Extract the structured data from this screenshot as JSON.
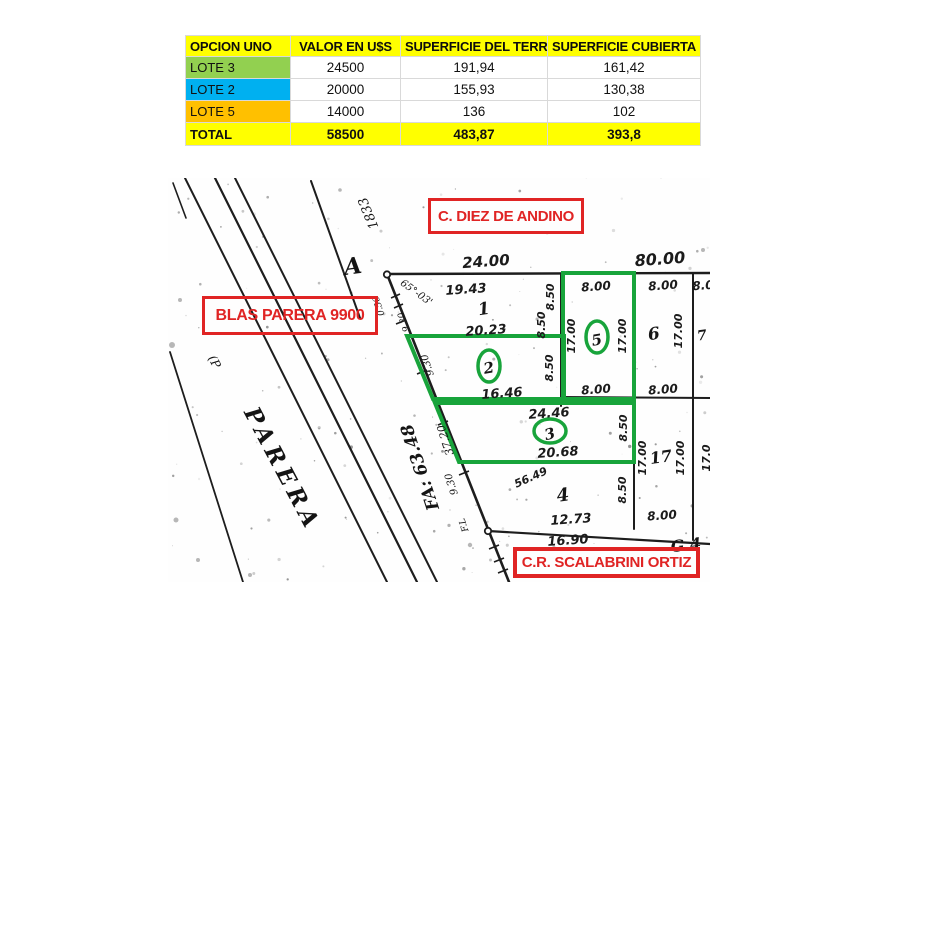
{
  "table": {
    "headers": [
      "OPCION UNO",
      "VALOR EN U$S",
      "SUPERFICIE DEL TERR.",
      "SUPERFICIE CUBIERTA"
    ],
    "header_bg": "#ffff00",
    "rows": [
      {
        "label": "LOTE 3",
        "color": "#92d050",
        "valor": "24500",
        "terreno": "191,94",
        "cubierta": "161,42"
      },
      {
        "label": "LOTE 2",
        "color": "#00b0f0",
        "valor": "20000",
        "terreno": "155,93",
        "cubierta": "130,38"
      },
      {
        "label": "LOTE 5",
        "color": "#ffc000",
        "valor": "14000",
        "terreno": "136",
        "cubierta": "102"
      }
    ],
    "total": {
      "label": "TOTAL",
      "valor": "58500",
      "terreno": "483,87",
      "cubierta": "393,8",
      "bg": "#ffff00"
    }
  },
  "map": {
    "labels": {
      "top_street": "C. DIEZ DE ANDINO",
      "left_street": "BLAS PARERA 9900",
      "bottom_street": "C.R. SCALABRINI ORTIZ"
    },
    "highlight_color": "#18a43b",
    "label_color": "#e02424",
    "highlighted_lots": [
      "2",
      "3",
      "5"
    ],
    "annotations": [
      {
        "t": "24.00",
        "x": 486,
        "y": 262,
        "r": -4,
        "fs": 15,
        "cls": "dim",
        "name": "dim-24-00"
      },
      {
        "t": "80.00",
        "x": 660,
        "y": 260,
        "r": -4,
        "fs": 16,
        "cls": "dim",
        "name": "dim-80-00"
      },
      {
        "t": "19.43",
        "x": 466,
        "y": 290,
        "r": -4,
        "fs": 13,
        "cls": "dim",
        "name": "dim-19-43"
      },
      {
        "t": "20.23",
        "x": 486,
        "y": 331,
        "r": -4,
        "fs": 13,
        "cls": "dim",
        "name": "dim-20-23"
      },
      {
        "t": "16.46",
        "x": 502,
        "y": 394,
        "r": -4,
        "fs": 13,
        "cls": "dim",
        "name": "dim-16-46"
      },
      {
        "t": "24.46",
        "x": 549,
        "y": 414,
        "r": -4,
        "fs": 13,
        "cls": "dim",
        "name": "dim-24-46"
      },
      {
        "t": "20.68",
        "x": 558,
        "y": 453,
        "r": -4,
        "fs": 13,
        "cls": "dim",
        "name": "dim-20-68"
      },
      {
        "t": "12.73",
        "x": 571,
        "y": 520,
        "r": -4,
        "fs": 13,
        "cls": "dim",
        "name": "dim-12-73"
      },
      {
        "t": "16.90",
        "x": 568,
        "y": 541,
        "r": -4,
        "fs": 13,
        "cls": "dim",
        "name": "dim-16-90"
      },
      {
        "t": "56.49",
        "x": 531,
        "y": 478,
        "r": -24,
        "fs": 11,
        "cls": "dim",
        "name": "dim-56-49"
      },
      {
        "t": "8.00",
        "x": 596,
        "y": 287,
        "r": -4,
        "fs": 12,
        "cls": "dim",
        "name": "dim-8-00-lot5-top"
      },
      {
        "t": "8.00",
        "x": 596,
        "y": 390,
        "r": -4,
        "fs": 12,
        "cls": "dim",
        "name": "dim-8-00-lot5-bottom"
      },
      {
        "t": "8.00",
        "x": 663,
        "y": 286,
        "r": -4,
        "fs": 12,
        "cls": "dim",
        "name": "dim-8-00-lot6-top"
      },
      {
        "t": "8.00",
        "x": 663,
        "y": 390,
        "r": -4,
        "fs": 12,
        "cls": "dim",
        "name": "dim-8-00-lot6-bottom"
      },
      {
        "t": "8.00",
        "x": 662,
        "y": 516,
        "r": -4,
        "fs": 12,
        "cls": "dim",
        "name": "dim-8-00-lot17-bottom"
      },
      {
        "t": "8.0",
        "x": 703,
        "y": 286,
        "r": -4,
        "fs": 12,
        "cls": "dim",
        "name": "dim-8-0-partial"
      },
      {
        "t": "8.50",
        "x": 551,
        "y": 297,
        "r": -90,
        "fs": 11,
        "cls": "dim",
        "name": "dim-8-50-a"
      },
      {
        "t": "8.50",
        "x": 542,
        "y": 325,
        "r": -90,
        "fs": 11,
        "cls": "dim",
        "name": "dim-8-50-b"
      },
      {
        "t": "8.50",
        "x": 550,
        "y": 368,
        "r": -90,
        "fs": 11,
        "cls": "dim",
        "name": "dim-8-50-c"
      },
      {
        "t": "17.00",
        "x": 572,
        "y": 336,
        "r": -90,
        "fs": 11,
        "cls": "dim",
        "name": "dim-17-00-lot5-left"
      },
      {
        "t": "17.00",
        "x": 623,
        "y": 336,
        "r": -90,
        "fs": 11,
        "cls": "dim",
        "name": "dim-17-00-lot5-right"
      },
      {
        "t": "17.00",
        "x": 679,
        "y": 331,
        "r": -90,
        "fs": 11,
        "cls": "dim",
        "name": "dim-17-00-lot6"
      },
      {
        "t": "8.50",
        "x": 624,
        "y": 428,
        "r": -90,
        "fs": 11,
        "cls": "dim",
        "name": "dim-8-50-lot3"
      },
      {
        "t": "8.50",
        "x": 623,
        "y": 490,
        "r": -90,
        "fs": 11,
        "cls": "dim",
        "name": "dim-8-50-lot4"
      },
      {
        "t": "17.00",
        "x": 643,
        "y": 458,
        "r": -90,
        "fs": 11,
        "cls": "dim",
        "name": "dim-17-00-lot17-left"
      },
      {
        "t": "17.00",
        "x": 681,
        "y": 458,
        "r": -90,
        "fs": 11,
        "cls": "dim",
        "name": "dim-17-00-lot17-right"
      },
      {
        "t": "17.0",
        "x": 707,
        "y": 458,
        "r": -90,
        "fs": 11,
        "cls": "dim",
        "name": "dim-17-0-partial"
      },
      {
        "t": "1",
        "x": 484,
        "y": 310,
        "r": -8,
        "fs": 17,
        "cls": "lotnum",
        "name": "lot-number-1"
      },
      {
        "t": "4",
        "x": 563,
        "y": 496,
        "r": -8,
        "fs": 18,
        "cls": "lotnum",
        "name": "lot-number-4"
      },
      {
        "t": "6",
        "x": 654,
        "y": 335,
        "r": -8,
        "fs": 17,
        "cls": "lotnum",
        "name": "lot-number-6"
      },
      {
        "t": "17",
        "x": 661,
        "y": 458,
        "r": -8,
        "fs": 16,
        "cls": "lotnum",
        "name": "lot-number-17"
      },
      {
        "t": "2",
        "x": 489,
        "y": 369,
        "r": -10,
        "fs": 15,
        "cls": "lotnum",
        "name": "lot-number-2-circled"
      },
      {
        "t": "3",
        "x": 550,
        "y": 435,
        "r": -15,
        "fs": 15,
        "cls": "lotnum",
        "name": "lot-number-3-circled"
      },
      {
        "t": "5",
        "x": 597,
        "y": 341,
        "r": -10,
        "fs": 15,
        "cls": "lotnum",
        "name": "lot-number-5-circled"
      },
      {
        "t": "G 4",
        "x": 686,
        "y": 546,
        "r": -6,
        "fs": 16,
        "cls": "lotnum",
        "name": "text-g4-partial"
      },
      {
        "t": "7",
        "x": 702,
        "y": 336,
        "r": -8,
        "fs": 14,
        "cls": "lotnum",
        "name": "lot-number-7-partial"
      },
      {
        "t": "1833",
        "x": 369,
        "y": 213,
        "r": -112,
        "fs": 13,
        "cls": "hand",
        "name": "hand-1833"
      },
      {
        "t": "65°-03'",
        "x": 416,
        "y": 293,
        "r": 36,
        "fs": 10,
        "cls": "hand",
        "name": "hand-angle-65-03"
      },
      {
        "t": "0.56",
        "x": 379,
        "y": 306,
        "r": -108,
        "fs": 9,
        "cls": "hand",
        "name": "hand-0-56"
      },
      {
        "t": "9.30",
        "x": 404,
        "y": 322,
        "r": -108,
        "fs": 9,
        "cls": "hand",
        "name": "hand-9-30-a"
      },
      {
        "t": "9.30",
        "x": 428,
        "y": 365,
        "r": -108,
        "fs": 10,
        "cls": "hand",
        "name": "hand-9-30-b"
      },
      {
        "t": "37.20",
        "x": 446,
        "y": 440,
        "r": -108,
        "fs": 11,
        "cls": "hand",
        "name": "hand-37-20"
      },
      {
        "t": "FA: 63.48",
        "x": 421,
        "y": 467,
        "r": -108,
        "fs": 17,
        "w": "bold",
        "cls": "hand",
        "name": "hand-fa-63-48"
      },
      {
        "t": "9.30",
        "x": 452,
        "y": 484,
        "r": -108,
        "fs": 10,
        "cls": "hand",
        "name": "hand-9-30-c"
      },
      {
        "t": "F.L",
        "x": 464,
        "y": 525,
        "r": -108,
        "fs": 9,
        "cls": "hand",
        "name": "hand-f-l"
      },
      {
        "t": "PARERA",
        "x": 281,
        "y": 470,
        "r": 62,
        "fs": 23,
        "w": "bold",
        "ls": 5,
        "cls": "hand",
        "name": "hand-parera-street-name"
      },
      {
        "t": "(P",
        "x": 214,
        "y": 362,
        "r": 62,
        "fs": 12,
        "cls": "hand",
        "name": "hand-paren-p"
      },
      {
        "t": "A",
        "x": 353,
        "y": 268,
        "r": -8,
        "fs": 23,
        "w": "bold",
        "cls": "hand",
        "name": "point-a-marker-label"
      }
    ]
  }
}
